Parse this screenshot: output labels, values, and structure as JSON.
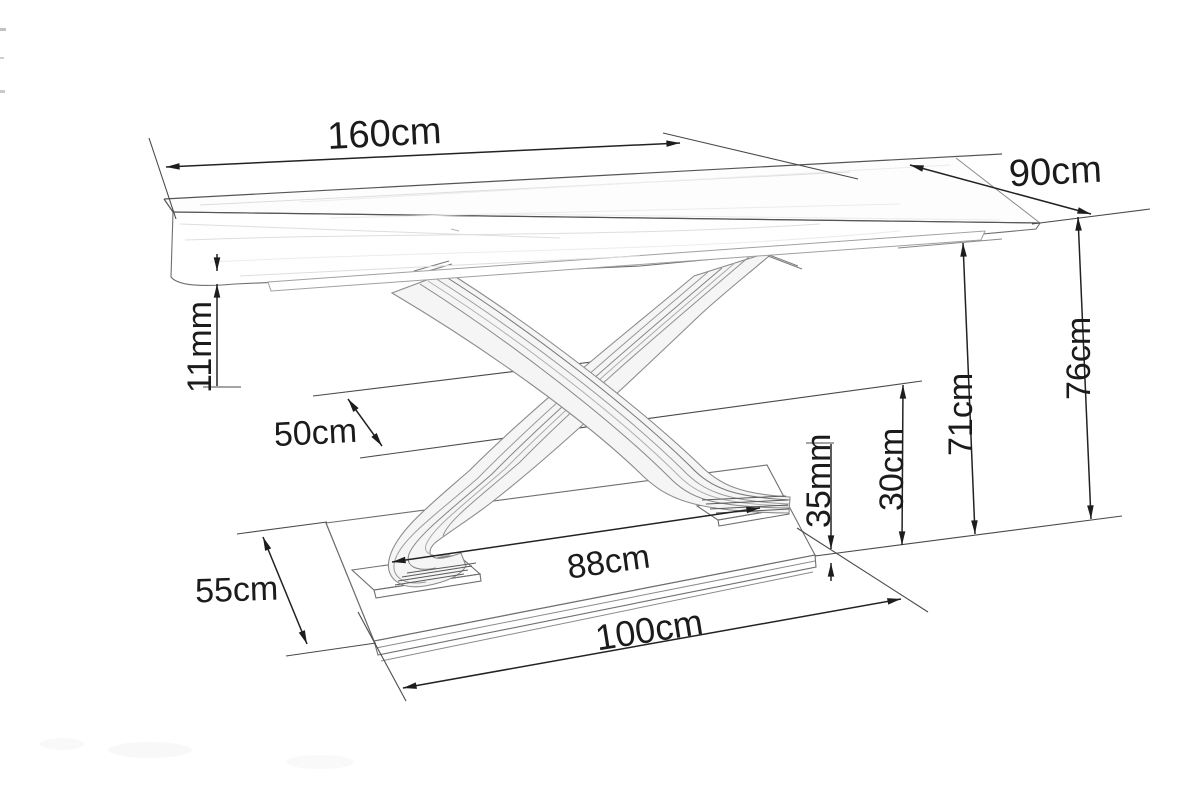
{
  "figure": {
    "type": "technical-dimension-drawing",
    "subject": "dining table with crossed ribbon pedestal",
    "line_color": "#222222",
    "background": "#ffffff"
  },
  "dimensions": [
    {
      "id": "top_length",
      "label": "160cm",
      "value": 160,
      "unit": "cm",
      "orientation": "horizontal"
    },
    {
      "id": "top_width",
      "label": "90cm",
      "value": 90,
      "unit": "cm",
      "orientation": "diagonal"
    },
    {
      "id": "top_thickness",
      "label": "11mm",
      "value": 11,
      "unit": "mm",
      "orientation": "vertical-rotated"
    },
    {
      "id": "mid_clearance",
      "label": "50cm",
      "value": 50,
      "unit": "cm",
      "orientation": "diagonal"
    },
    {
      "id": "height_total",
      "label": "76cm",
      "value": 76,
      "unit": "cm",
      "orientation": "vertical-rotated"
    },
    {
      "id": "height_under_top",
      "label": "71cm",
      "value": 71,
      "unit": "cm",
      "orientation": "vertical-rotated"
    },
    {
      "id": "lower_clearance",
      "label": "30cm",
      "value": 30,
      "unit": "cm",
      "orientation": "vertical-rotated"
    },
    {
      "id": "base_plate_thickness",
      "label": "35mm",
      "value": 35,
      "unit": "mm",
      "orientation": "vertical-rotated"
    },
    {
      "id": "feet_span",
      "label": "88cm",
      "value": 88,
      "unit": "cm",
      "orientation": "horizontal"
    },
    {
      "id": "base_depth",
      "label": "55cm",
      "value": 55,
      "unit": "cm",
      "orientation": "horizontal"
    },
    {
      "id": "base_length",
      "label": "100cm",
      "value": 100,
      "unit": "cm",
      "orientation": "horizontal"
    }
  ]
}
